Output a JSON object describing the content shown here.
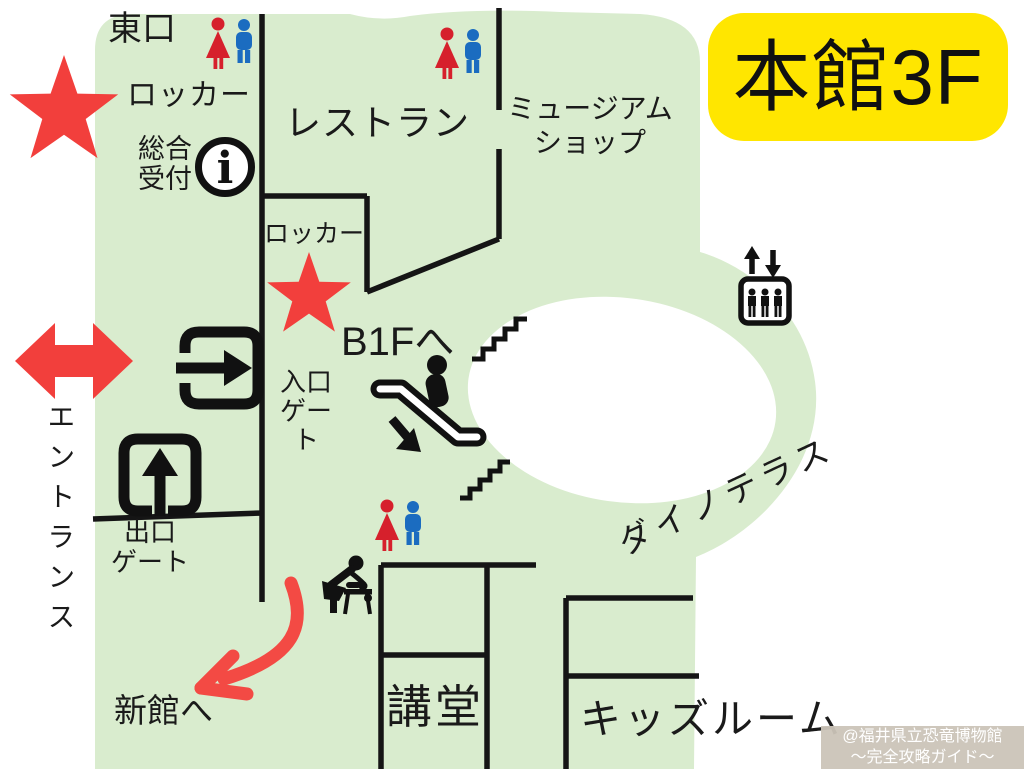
{
  "badge": {
    "text": "本館3F"
  },
  "areas": {
    "east_exit": "東口",
    "locker_top": "ロッカー",
    "reception_l1": "総合",
    "reception_l2": "受付",
    "restaurant": "レストラン",
    "museum_shop_l1": "ミュージアム",
    "museum_shop_l2": "ショップ",
    "locker_mid": "ロッカー",
    "to_b1f": "B1Fへ",
    "entry_gate_l1": "入口",
    "entry_gate_l2": "ゲート",
    "exit_gate_l1": "出口",
    "exit_gate_l2": "ゲート",
    "entrance": "エントランス",
    "to_new_building": "新館へ",
    "auditorium": "講堂",
    "kids_room": "キッズルーム",
    "dino_terrace": "ダイノテラス"
  },
  "icons": {
    "info_glyph": "i",
    "names": [
      "restroom-icon",
      "star-marker-icon",
      "info-icon",
      "entry-gate-icon",
      "exit-gate-icon",
      "escalator-down-icon",
      "stairs-icon",
      "elevator-icon",
      "baby-changing-icon",
      "entrance-double-arrow-icon",
      "route-arrow-icon"
    ]
  },
  "colors": {
    "floor_green": "#d9ecce",
    "badge_yellow": "#ffe600",
    "marker_red": "#f23f3c",
    "restroom_red": "#d6202c",
    "restroom_blue": "#1b6cc0",
    "wall_black": "#151515",
    "watermark_bg": "#cbc4b8",
    "watermark_text": "#ffffff"
  },
  "watermark": {
    "line1": "@福井県立恐竜博物館",
    "line2": "～完全攻略ガイド～"
  }
}
